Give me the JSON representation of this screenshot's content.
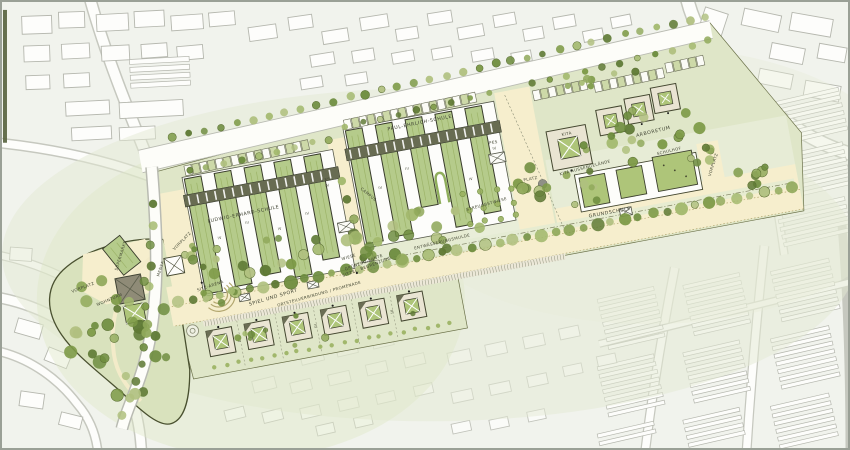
{
  "plan": {
    "labels": {
      "supermarkt": "SUPERMARKT",
      "wohnturm": "WOHNTURM",
      "vorplatz_west": "VORPLATZ",
      "vorplatz_schule": "VORPLATZ",
      "vorplatz_grundschule": "VORPLATZ",
      "mensa": "MENSA",
      "ludwig_erhard_schule": "LUDWIG-ERHARD-SCHULE",
      "paul_ehrlich_schule": "PAUL-EHRLICH-SCHULE",
      "les": "LES",
      "pes": "PES",
      "grundschule": "GRUNDSCHULE",
      "kita": "KITA",
      "kita_aussengelaende": "KITA-AUSSENGELÄNDE",
      "arboretum": "ARBORETUM",
      "schulhof": "SCHULHOF",
      "platz": "PLATZ",
      "wiese": "WIESE",
      "spiel_und_sport": "SPIEL UND SPORT",
      "sitz_arena": "SITZ-ARENA",
      "gruenzug_kante": "GRÜNZUG-KANTE",
      "sitzel_begrenzung": "SITZEL. BEGRENZUNG",
      "entwaesserungsmulde": "ENTWÄSSERUNGSMULDE",
      "ortsteilverbindung": "ORTSTEILVERBINDUNG / PROMENADE",
      "streuobstwiese": "STREUOBSTWIESE",
      "campus": "CAMPUS"
    },
    "storeys": {
      "three": "III",
      "four": "IV"
    },
    "colors": {
      "background": "#f1f3ed",
      "site_green": "#dfe6c8",
      "lawn_light": "#e9edd6",
      "path_cream": "#f6eecd",
      "building_green": "#b5cb8b",
      "courtyard_green": "#aec579",
      "spine_dark": "#686c52",
      "outline_dark": "#3c3f2e",
      "boundary": "#49502f",
      "context_stroke": "#b5b7ae",
      "road_casing": "#c6c8bf",
      "tree_greens": [
        "#90a95b",
        "#7d9a47",
        "#a3b96e",
        "#6d8c3e",
        "#b0c07f",
        "#5f7a35"
      ]
    }
  }
}
